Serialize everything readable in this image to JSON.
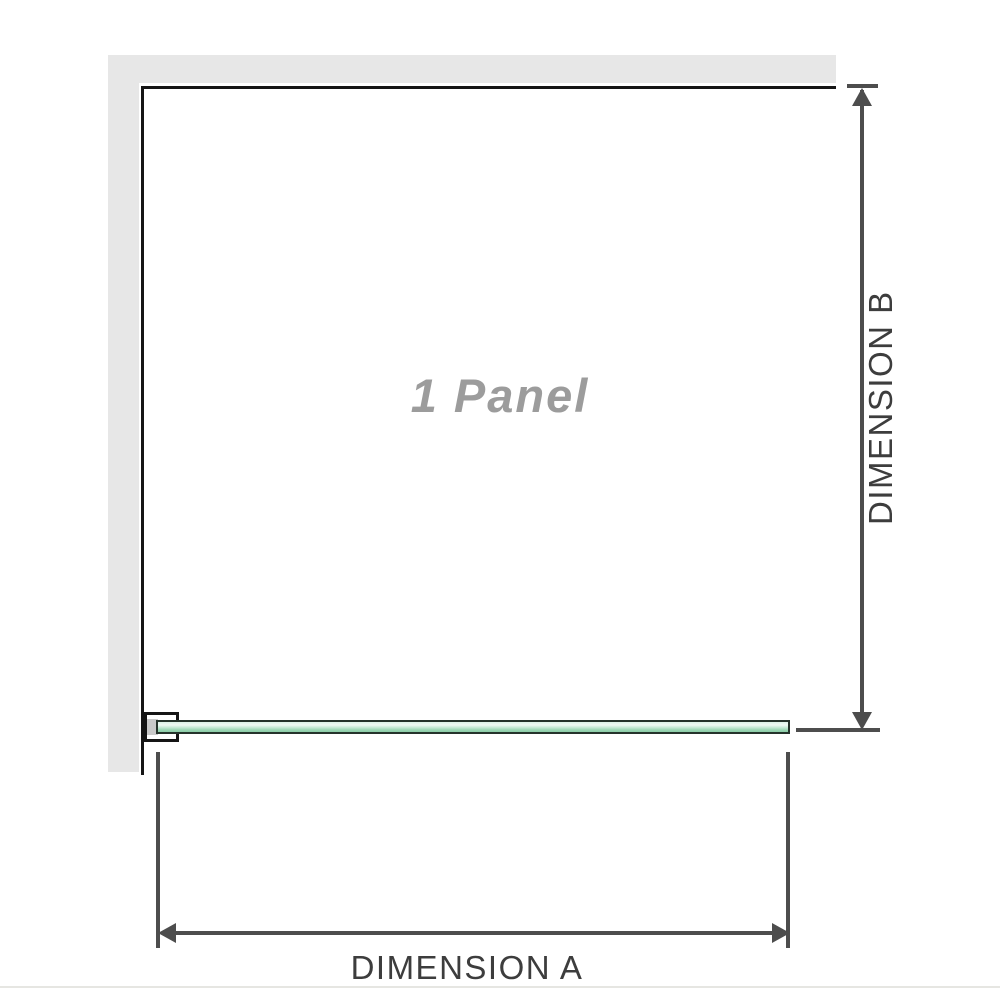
{
  "diagram": {
    "panel_label": "1 Panel",
    "dimension_a_label": "DIMENSION A",
    "dimension_b_label": "DIMENSION B"
  },
  "icons": {
    "arrow_up": "dimension-b upper arrowhead",
    "arrow_down": "dimension-b lower arrowhead",
    "arrow_left": "dimension-a left arrowhead",
    "arrow_right": "dimension-a right arrowhead"
  },
  "colors": {
    "page_bg": "#ffffff",
    "wall": "#e7e7e7",
    "frame": "#151515",
    "glass_green": "#9bd6b4",
    "glass_light": "#ddf2e7",
    "glass_edge": "#25332b",
    "bracket_fill": "#ffffff",
    "bracket_inner": "#c9c9c9",
    "dim": "#4d4d4d",
    "label_text": "#3d3d3d",
    "panel_text": "#9c9c9c",
    "page_edge": "#e6e6e2"
  }
}
